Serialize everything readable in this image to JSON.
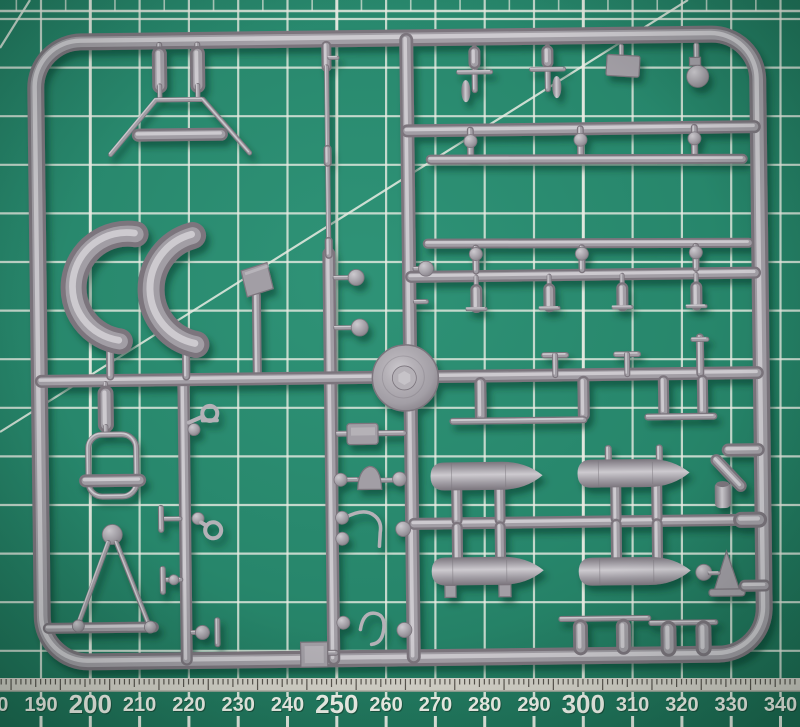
{
  "scene": {
    "description": "Grey injection-moulded model kit sprue photographed on a green self-healing cutting mat with white grid lines, diagonal guides and millimetre rulers along the top and bottom edges",
    "object": "plastic-model-sprue",
    "surface": "cutting-mat"
  },
  "colors": {
    "mat_base": "#27866b",
    "mat_light": "#2f9377",
    "mat_dark": "#1d6f55",
    "grid_line": "#e9ece3",
    "ruler_strip": "#d8d5cc",
    "tick_dark": "#453f3a",
    "num_white": "#f5f7ef",
    "sprue_base": "#a29ea5",
    "sprue_mid": "#b5b1b7",
    "sprue_hi": "#cdcacf",
    "sprue_lo": "#7b757d",
    "shadow": "#062e1f"
  },
  "grid": {
    "spacing": 49.3,
    "v_origin": -8.3,
    "v_first": 0,
    "v_last": 16,
    "top": 0,
    "bottom": 678,
    "h_origin": 19,
    "h_spacing": 48.6,
    "h_count": 14,
    "band_y": 11,
    "bold_v": [
      2,
      7,
      12
    ],
    "diagonals": [
      [
        0,
        432,
        688,
        0
      ],
      [
        30,
        0,
        0,
        48
      ]
    ]
  },
  "ruler": {
    "unit": "mm",
    "start_x": -8.3,
    "step_px": 49.3,
    "baseline_y": 711,
    "baseline_big_y": 713,
    "strip_top": 678,
    "strip_h": 13,
    "mm_px": 4.93,
    "mm_origin": 1.2,
    "mm_count": 162,
    "mm_major_mod": 2,
    "mm_mid_mod": 7,
    "labels": [
      {
        "text": "180",
        "bold": false
      },
      {
        "text": "190",
        "bold": false
      },
      {
        "text": "200",
        "bold": true
      },
      {
        "text": "210",
        "bold": false
      },
      {
        "text": "220",
        "bold": false
      },
      {
        "text": "230",
        "bold": false
      },
      {
        "text": "240",
        "bold": false
      },
      {
        "text": "250",
        "bold": true
      },
      {
        "text": "260",
        "bold": false
      },
      {
        "text": "270",
        "bold": false
      },
      {
        "text": "280",
        "bold": false
      },
      {
        "text": "290",
        "bold": false
      },
      {
        "text": "300",
        "bold": true
      },
      {
        "text": "310",
        "bold": false
      },
      {
        "text": "320",
        "bold": false
      },
      {
        "text": "330",
        "bold": false
      },
      {
        "text": "340",
        "bold": false
      }
    ]
  },
  "sprue": {
    "material": "grey styrene",
    "parts": [
      "rectangular-frame",
      "left-vertical-runner",
      "center-vertical-runner",
      "right-vertical-runner",
      "top-horizontal-runner",
      "middle-horizontal-runner",
      "upper-right-crossbar",
      "lower-right-crossbar",
      "landing-gear-strut-frame",
      "spreader-bar",
      "small-bomb",
      "small-bomb",
      "cowling-panel",
      "cowling-panel",
      "wheel-disc",
      "long-wing-strut",
      "long-wing-strut",
      "torpedo-tank",
      "torpedo-tank",
      "torpedo-tank",
      "torpedo-tank",
      "walkway-strip",
      "walkway-strip",
      "bomb-cradle-yoke",
      "a-frame-strut",
      "aerial-mast",
      "headrest-block",
      "exhaust-stub-cluster",
      "intake-funnel",
      "venturi-ball",
      "d-ring-fitting",
      "d-ring-fitting",
      "control-horn-wire",
      "control-horn-wire",
      "small-fittings"
    ]
  }
}
